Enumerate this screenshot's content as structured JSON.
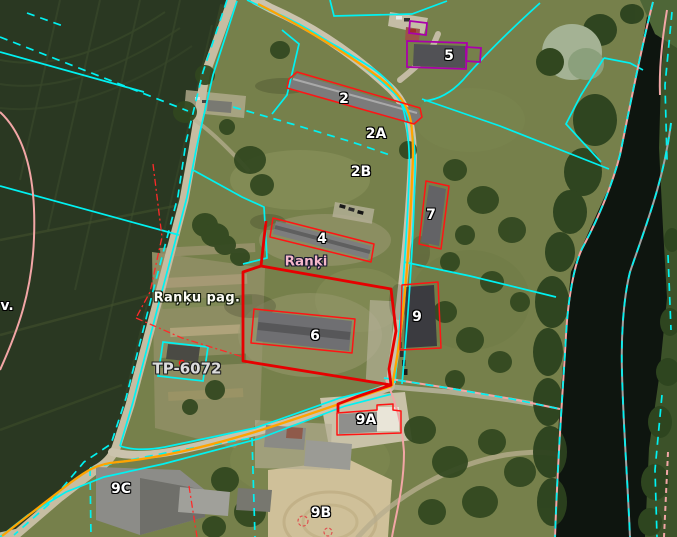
{
  "map": {
    "type": "aerial-cadastral-map-view",
    "labels": {
      "b2": "2",
      "b2a": "2A",
      "b2b": "2B",
      "b4": "4",
      "b5": "5",
      "b6": "6",
      "b7": "7",
      "b9": "9",
      "b9a": "9A",
      "b9b": "9B",
      "b9c": "9C",
      "village": "Raņķi",
      "parish": "Raņķu pag.",
      "transformer": "TP-6072",
      "edge_partial": "v."
    }
  },
  "colors": {
    "cadastral": "#00f2f2",
    "road_axis": "#ffa400",
    "selected_parcel": "#e60000",
    "building_outline": "#ff1414",
    "zone_pink": "#f2a6a6",
    "protected_purple": "#aa00aa",
    "river_axis": "#a2a2a2",
    "label_white": "#ffffff",
    "label_pink": "#f5b8cb",
    "label_gray": "#dcdcdc"
  }
}
